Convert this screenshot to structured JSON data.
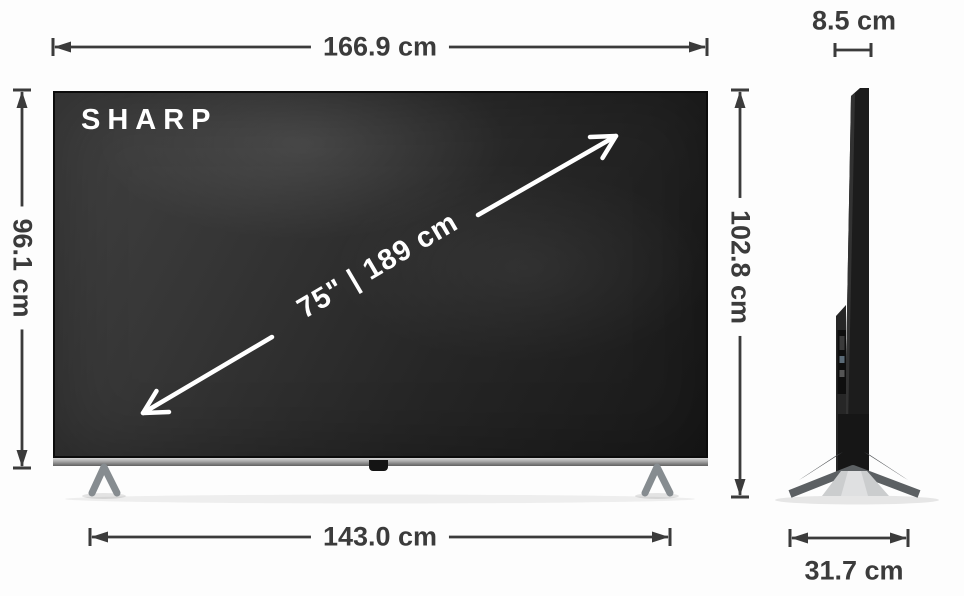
{
  "diagram": {
    "brand": "SHARP",
    "screen_size_label": "75\" | 189 cm",
    "dimensions": {
      "width_label": "166.9 cm",
      "screen_height_label": "96.1 cm",
      "overall_height_label": "102.8 cm",
      "stand_width_label": "143.0 cm",
      "depth_label": "8.5 cm",
      "stand_depth_label": "31.7 cm"
    },
    "colors": {
      "dimension_ink": "#3b3b3b",
      "screen_overlay_text": "#ffffff",
      "screen_dark": "#1e1e1e",
      "canvas": "#fdfdfd",
      "stand_silver": "#c9cbcc"
    }
  }
}
